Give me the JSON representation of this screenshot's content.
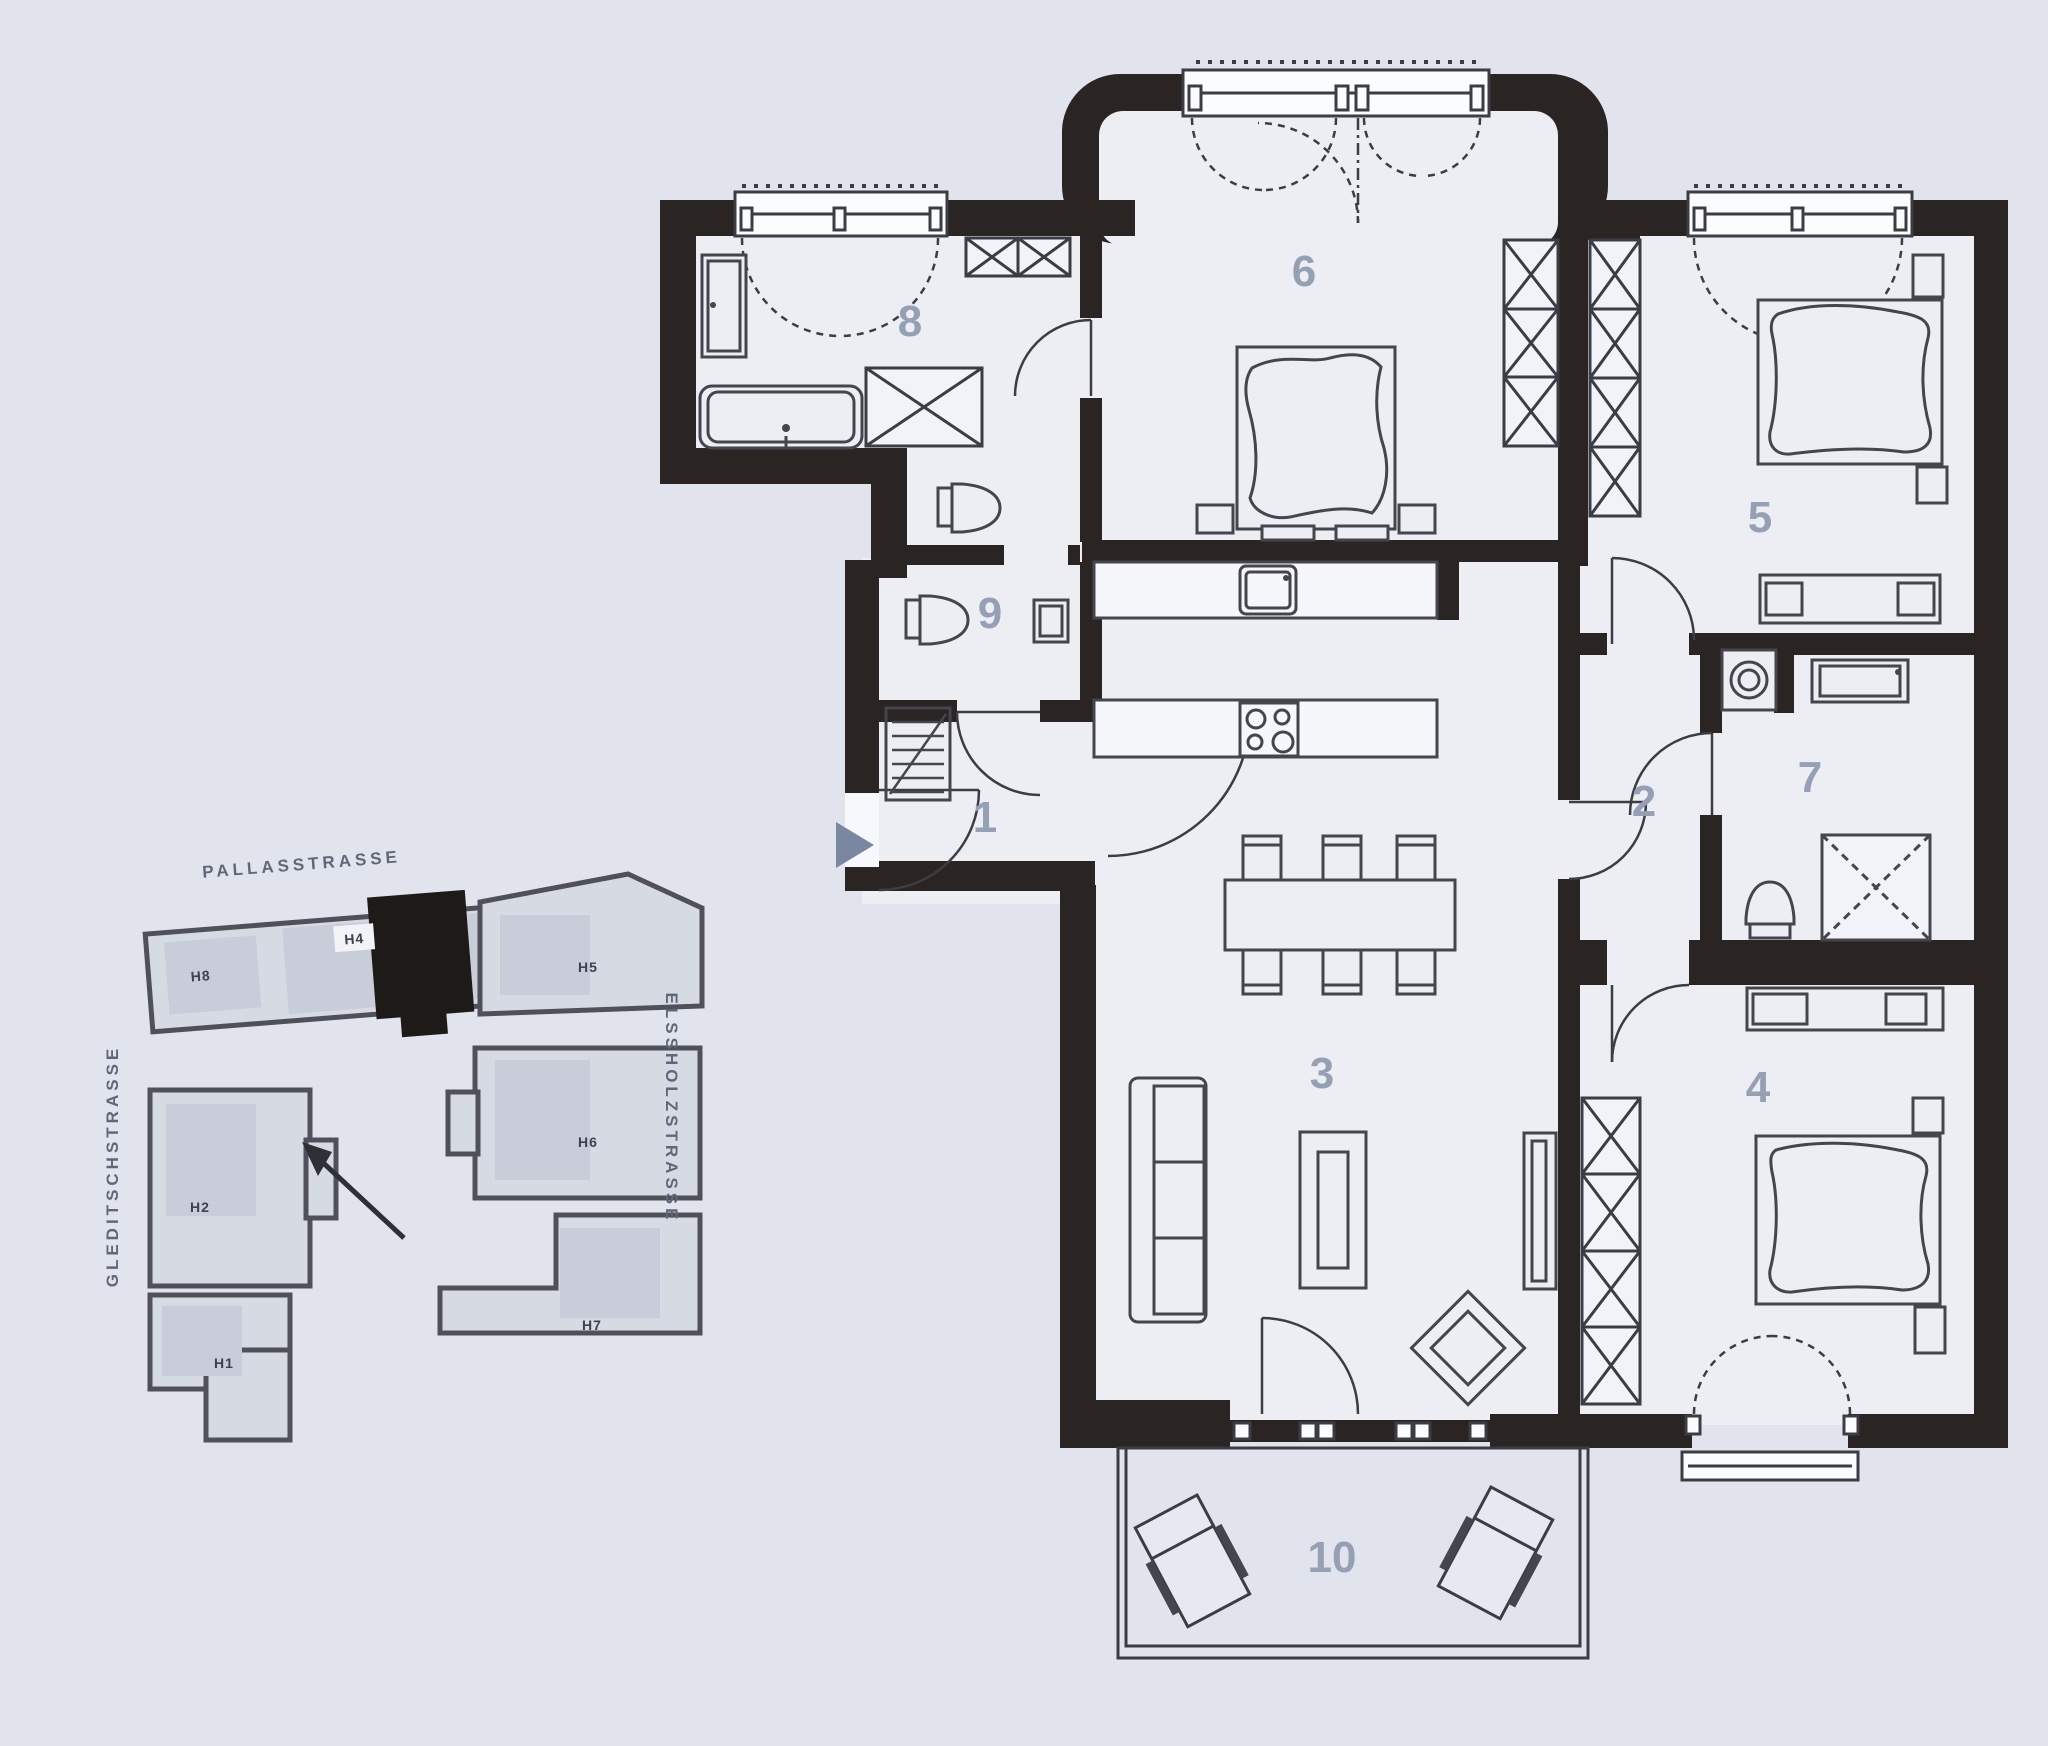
{
  "floor_plan": {
    "rooms": [
      {
        "number": "1"
      },
      {
        "number": "2"
      },
      {
        "number": "3"
      },
      {
        "number": "4"
      },
      {
        "number": "5"
      },
      {
        "number": "6"
      },
      {
        "number": "7"
      },
      {
        "number": "8"
      },
      {
        "number": "9"
      },
      {
        "number": "10"
      }
    ],
    "fixtures": [
      "bathtub",
      "shower",
      "toilet",
      "sink",
      "washing-machine",
      "kitchen-sink",
      "stove",
      "dining-table",
      "sofa",
      "coffee-table",
      "armchair",
      "bed",
      "wardrobe-shaft",
      "lounge-chair",
      "coat-rack"
    ]
  },
  "site_plan": {
    "streets": {
      "north": "PALLASSTRASSE",
      "west": "GLEDITSCHSTRASSE",
      "east": "ELSSHOLZSTRASSE"
    },
    "buildings": [
      {
        "label": "H8"
      },
      {
        "label": "H4"
      },
      {
        "label": "H5"
      },
      {
        "label": "H2"
      },
      {
        "label": "H6"
      },
      {
        "label": "H1"
      },
      {
        "label": "H7"
      }
    ],
    "highlighted_building": "H4"
  },
  "colors": {
    "background": "#e2e4ed",
    "room_fill": "#eceef4",
    "wall": "#2a2522",
    "room_label": "#96a0b4",
    "site_building_fill": "#d6dae3",
    "site_building_stroke": "#50505a",
    "highlight_building": "#1e1a18",
    "street_text": "#5e6878",
    "entry_arrow": "#7b87a0"
  }
}
